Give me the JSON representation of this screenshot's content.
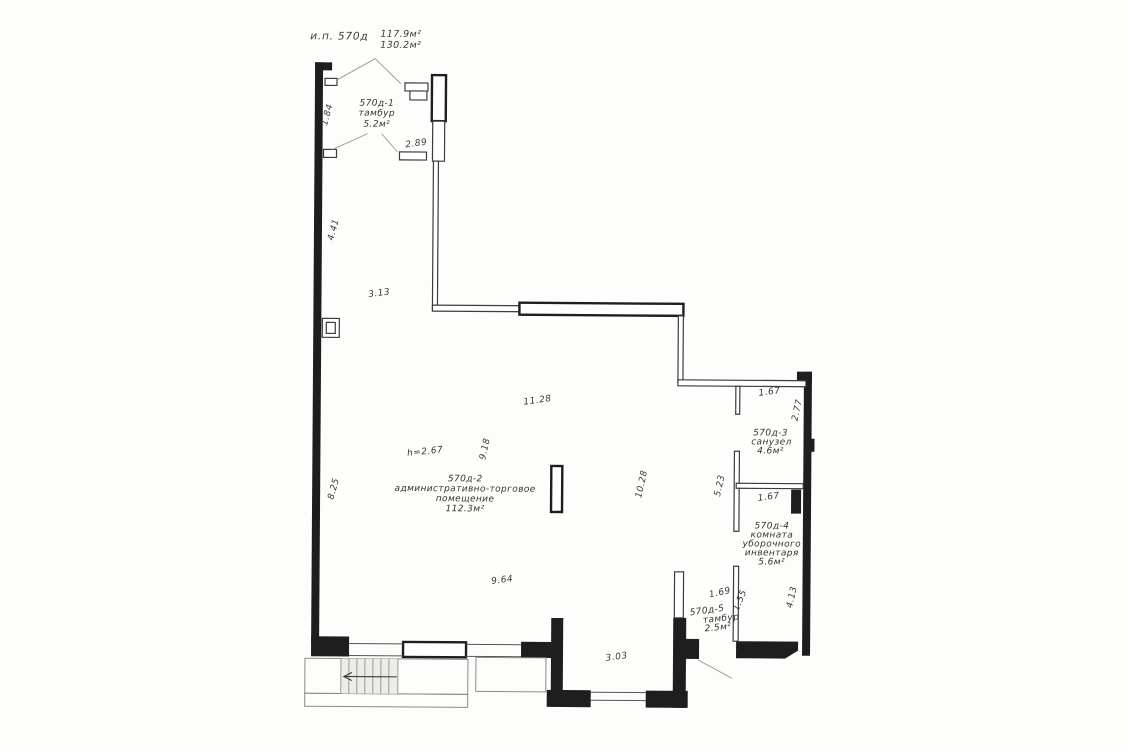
{
  "header": {
    "unit_label": "и.п. 570д",
    "area_line1": "117.9м²",
    "area_line2": "130.2м²"
  },
  "rooms": {
    "r1": {
      "id": "570д-1",
      "name": "тамбур",
      "area": "5.2м²"
    },
    "r2": {
      "id": "570д-2",
      "name_line1": "административно-торговое",
      "name_line2": "помещение",
      "area": "112.3м²"
    },
    "r3": {
      "id": "570д-3",
      "name": "санузел",
      "area": "4.6м²"
    },
    "r4": {
      "id": "570д-4",
      "name_line1": "комната",
      "name_line2": "уборочного",
      "name_line3": "инвентаря",
      "area": "5.6м²"
    },
    "r5": {
      "id": "570д-5",
      "name": "тамбур",
      "area": "2.5м²"
    }
  },
  "dims": {
    "ceiling_height": "h=2.67",
    "tambour_side": "1.84",
    "tambour_width": "2.89",
    "left_wall_upper": "4.41",
    "upper_inner": "3.13",
    "left_wall_lower": "8.25",
    "main_width_top": "11.28",
    "main_depth_mid": "9.18",
    "main_depth_right": "10.28",
    "main_width_bottom": "9.64",
    "wc_width": "1.67",
    "wc_depth": "2.77",
    "storage_width": "1.67",
    "corridor_depth": "5.23",
    "tambour5_width": "1.69",
    "tambour5_depth": "1.55",
    "right_wall_lower": "4.13",
    "entry_niche_width": "3.03"
  }
}
